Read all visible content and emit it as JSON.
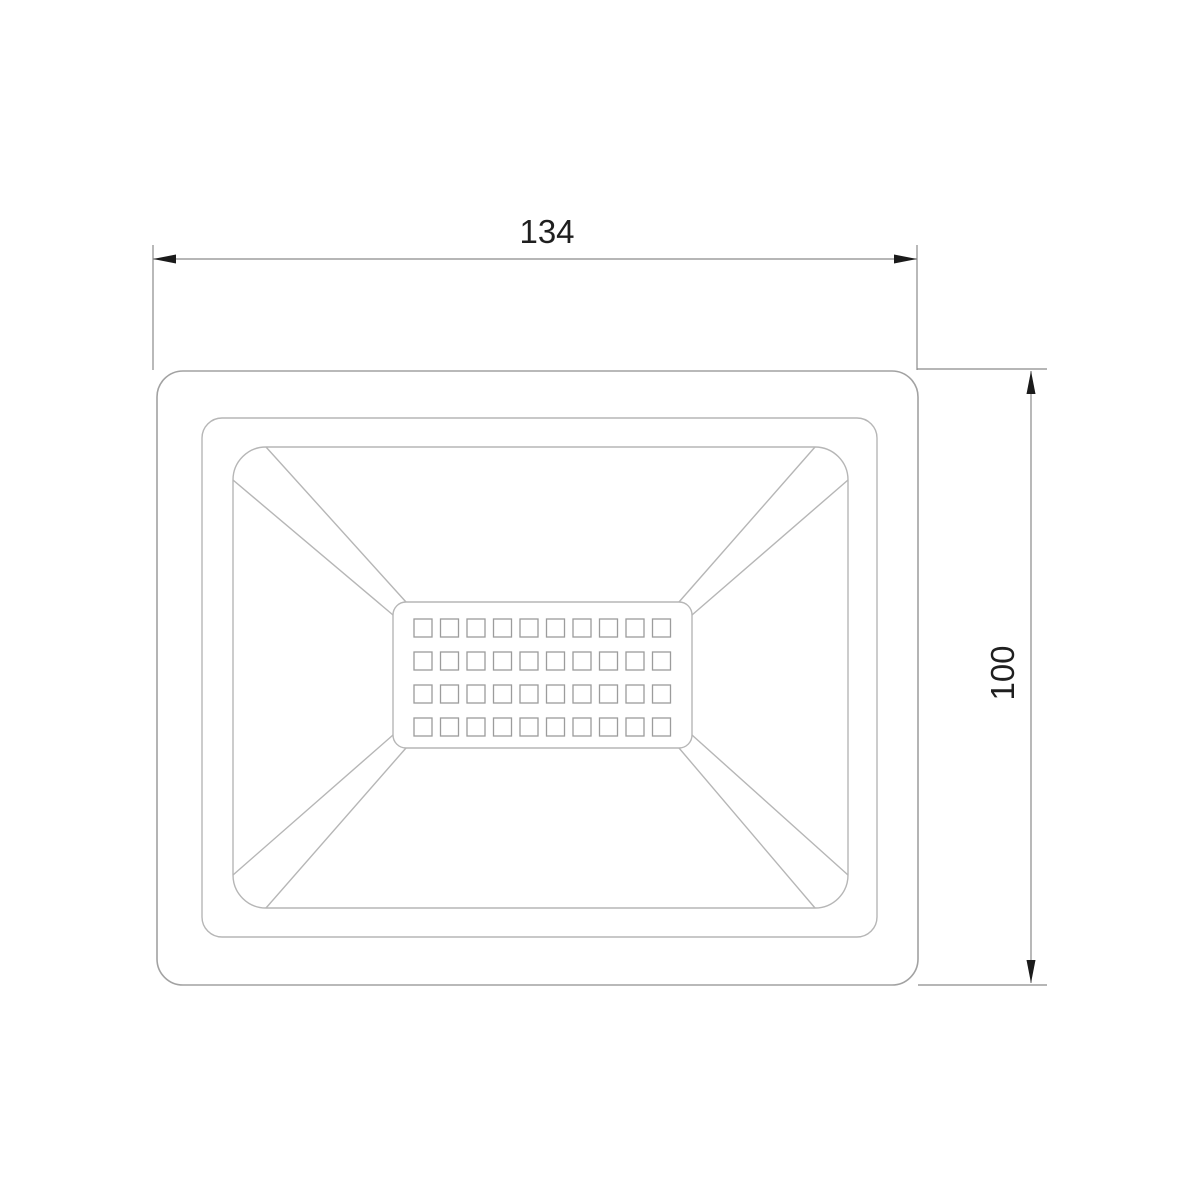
{
  "colors": {
    "background": "#ffffff",
    "body_outline": "#a2a2a2",
    "inner_outline": "#b6b6b6",
    "led_outline": "#9c9c9c",
    "dimension_line": "#8a8a8a",
    "arrow_fill": "#1b1b1b",
    "text_color": "#1f1f1f"
  },
  "dimension_width": {
    "label": "134"
  },
  "dimension_height": {
    "label": "100"
  },
  "led_grid": {
    "rows": 4,
    "columns": 10
  }
}
